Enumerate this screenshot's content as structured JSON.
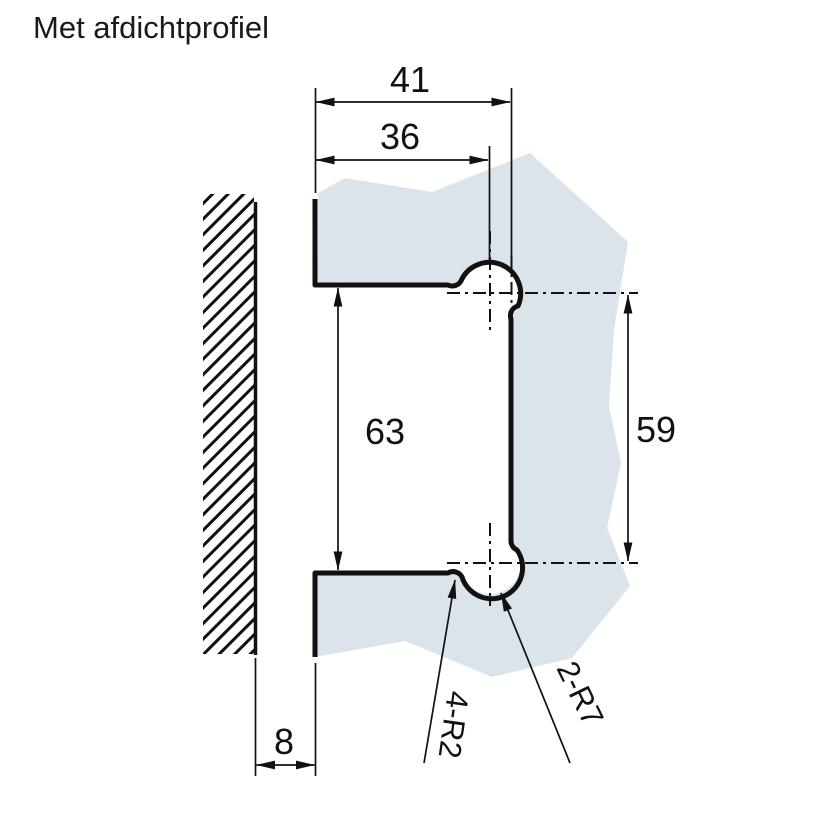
{
  "title": "Met afdichtprofiel",
  "colors": {
    "background": "#ffffff",
    "glass": "#dbe4eb",
    "line": "#111111"
  },
  "dimensions": {
    "outer_width": "41",
    "inner_width": "36",
    "left_height": "63",
    "right_height": "59",
    "wall_offset": "8"
  },
  "radius_labels": {
    "fillets": "4-R2",
    "arcs": "2-R7"
  }
}
